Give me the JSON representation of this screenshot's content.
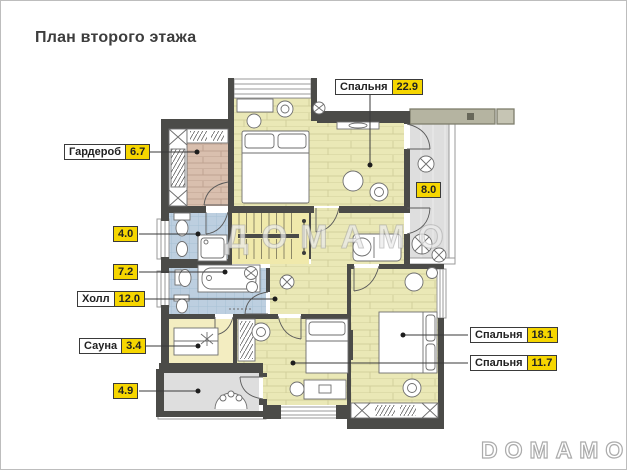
{
  "title": "План второго этажа",
  "watermark_text": "ДОМАМО",
  "brand_logo": "DOMAMO",
  "colors": {
    "accent_yellow": "#f6d600",
    "wall": "#4b4b48",
    "bedroom_floor": "#eae8b6",
    "wardrobe_floor": "#d9bfae",
    "bathroom_floor": "#bdcfe0",
    "sauna_floor": "#f3edc1",
    "stairs_floor": "#f0e9ab",
    "balcony_floor": "#dedede",
    "roof_bar": "#b5b4a1"
  },
  "labels": {
    "bedroom_top": {
      "name": "Спальня",
      "value": "22.9"
    },
    "wardrobe": {
      "name": "Гардероб",
      "value": "6.7"
    },
    "balcony_right": {
      "value": "8.0"
    },
    "wc": {
      "value": "4.0"
    },
    "bathroom": {
      "value": "7.2"
    },
    "hall": {
      "name": "Холл",
      "value": "12.0"
    },
    "sauna": {
      "name": "Сауна",
      "value": "3.4"
    },
    "balcony_bottom": {
      "value": "4.9"
    },
    "bedroom_right": {
      "name": "Спальня",
      "value": "18.1"
    },
    "bedroom_bottom": {
      "name": "Спальня",
      "value": "11.7"
    }
  }
}
